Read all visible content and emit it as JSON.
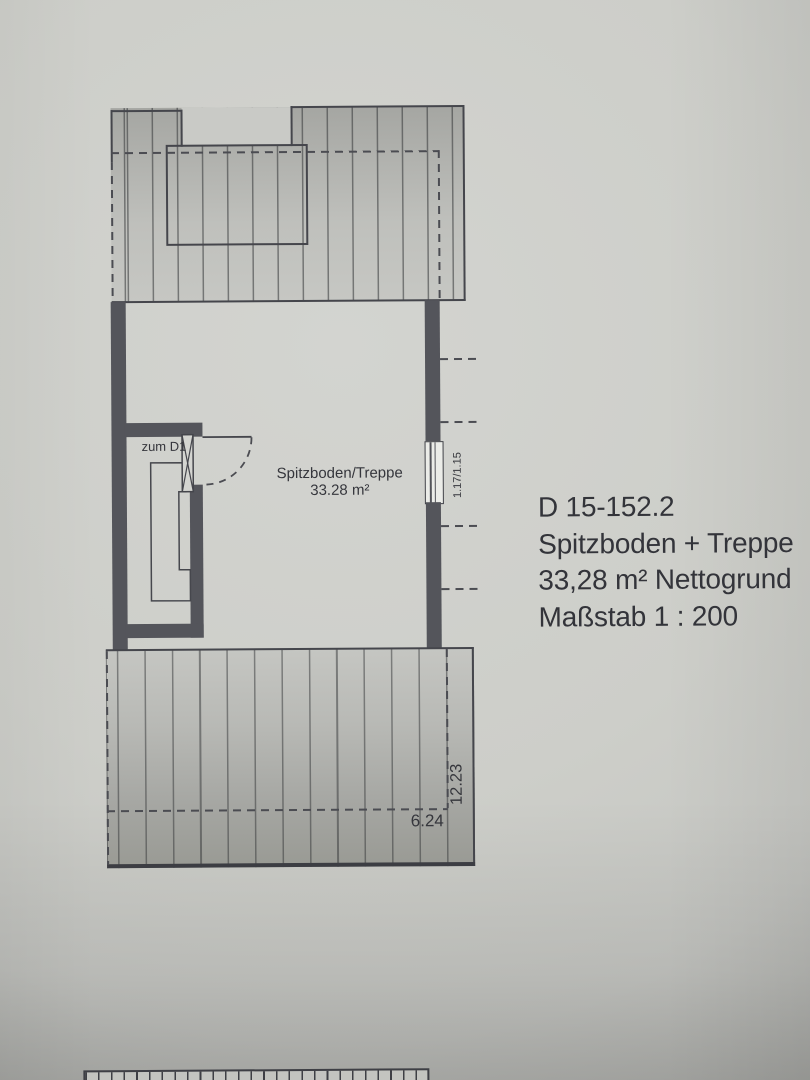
{
  "plan": {
    "room": {
      "name": "Spitzboden/Treppe",
      "area": "33.28 m²"
    },
    "stair_door_label": "zum D1",
    "window_dimension": "1.17/1.15",
    "dimensions": {
      "width": "6.24",
      "depth": "12.23"
    }
  },
  "legend": {
    "drawing_number": "D 15-152.2",
    "title": "Spitzboden + Treppe",
    "area": "33,28 m² Nettogrund",
    "scale": "Maßstab 1 : 200"
  },
  "colors": {
    "paper": "#cdcec9",
    "hatch_fill": "#b5b6b2",
    "wall": "#54555b",
    "line": "#45464c",
    "text": "#33343a"
  }
}
